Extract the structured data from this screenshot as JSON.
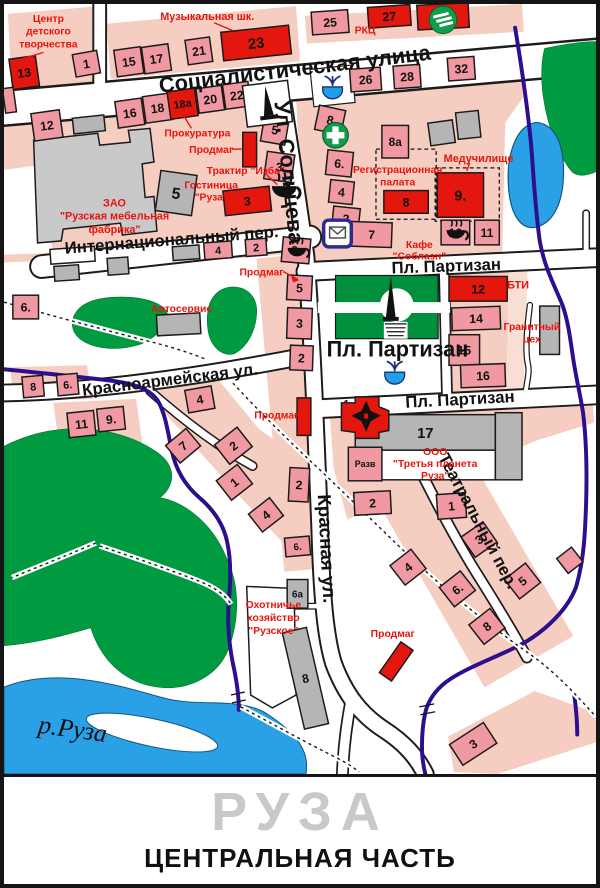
{
  "footer": {
    "city": "РУЗА",
    "subtitle": "ЦЕНТРАЛЬНАЯ ЧАСТЬ"
  },
  "colors": {
    "label_red": "#e8140c",
    "building_red": "#e3170d",
    "building_pink": "#f099a3",
    "block_pink": "#f6cdc1",
    "green": "#009a40",
    "river_blue": "#2aa1e6",
    "stream_purple": "#2c0e8f",
    "road_white": "#ffffff",
    "title_gray": "#c9c9c9"
  },
  "icons": {
    "pharmacy": "green circle with white cross",
    "sberbank": "green circle with three white stripes",
    "post-office": "envelope in blue rounded square",
    "fountain": "blue bowl with water jets",
    "monument": "black obelisk on white square",
    "park-obelisk": "black obelisk with stairs in park circle",
    "church": "red building with black cross",
    "cafe": "black coffee cup with steam"
  },
  "streets": [
    {
      "id": "sotsialisticheskaya",
      "label": "Социалистическая улица",
      "x": 158,
      "y": 90,
      "rot": -7,
      "size": 22
    },
    {
      "id": "solntseva",
      "label": "Ул. Солнцева",
      "x": 274,
      "y": 99,
      "rot": 84,
      "size": 22
    },
    {
      "id": "krasnaya",
      "label": "Красная ул.",
      "x": 318,
      "y": 497,
      "rot": 87,
      "size": 19
    },
    {
      "id": "internatsionalny",
      "label": "Интернациональный пер.",
      "x": 62,
      "y": 253,
      "rot": -4.5,
      "size": 17
    },
    {
      "id": "krasnoarmeyskaya",
      "label": "Красноармейская ул.",
      "x": 80,
      "y": 397,
      "rot": -7,
      "size": 17
    },
    {
      "id": "partizan-upper",
      "label": "Пл. Партизан",
      "x": 393,
      "y": 273,
      "rot": -2,
      "size": 17
    },
    {
      "id": "partizan-square",
      "label": "Пл. Партизан",
      "x": 327,
      "y": 357,
      "rot": 0,
      "size": 22
    },
    {
      "id": "partizan-lower",
      "label": "Пл. Партизан",
      "x": 407,
      "y": 409,
      "rot": -3,
      "size": 17
    },
    {
      "id": "teatralny",
      "label": "Театральный пер.",
      "x": 440,
      "y": 459,
      "rot": 62,
      "size": 17
    },
    {
      "id": "river-ruza",
      "label": "р.Руза",
      "x": 34,
      "y": 738,
      "rot": 8,
      "size": 26,
      "serif": true
    }
  ],
  "poi_labels": [
    {
      "id": "tsentr-tvorchestva",
      "lines": [
        "Центр",
        "детского",
        "творчества"
      ],
      "x": 45,
      "y": 18,
      "lh": 13,
      "size": 10.5
    },
    {
      "id": "muz-shkola",
      "lines": [
        "Музыкальная шк."
      ],
      "x": 206,
      "y": 16,
      "size": 11
    },
    {
      "id": "rkts",
      "lines": [
        "РКЦ"
      ],
      "x": 366,
      "y": 30,
      "size": 10.5
    },
    {
      "id": "prokuratura",
      "lines": [
        "Прокуратура"
      ],
      "x": 196,
      "y": 134,
      "size": 10.5
    },
    {
      "id": "prodmag-1",
      "lines": [
        "Продмаг"
      ],
      "x": 210,
      "y": 151,
      "size": 10.5
    },
    {
      "id": "traktir-izba",
      "lines": [
        "Трактир \"Изба\""
      ],
      "x": 245,
      "y": 172,
      "size": 10.5
    },
    {
      "id": "gostinitsa-ruza",
      "lines": [
        "Гостиница",
        "\"Руза\""
      ],
      "x": 210,
      "y": 187,
      "lh": 12,
      "size": 10.5
    },
    {
      "id": "mebelnaya-fabrika",
      "lines": [
        "ЗАО",
        "\"Рузская мебельная",
        "фабрика\""
      ],
      "x": 112,
      "y": 205,
      "lh": 13.5,
      "size": 11
    },
    {
      "id": "reg-palata",
      "lines": [
        "Регистрационная",
        "палата"
      ],
      "x": 399,
      "y": 171,
      "lh": 13,
      "size": 10.5
    },
    {
      "id": "meduchilishche",
      "lines": [
        "Медучилище"
      ],
      "x": 481,
      "y": 160,
      "size": 11
    },
    {
      "id": "kafe-soblazn",
      "lines": [
        "Кафе",
        "\"Соблазн\""
      ],
      "x": 421,
      "y": 247,
      "lh": 12,
      "size": 10.5
    },
    {
      "id": "bti",
      "lines": [
        "БТИ"
      ],
      "x": 521,
      "y": 288,
      "size": 11
    },
    {
      "id": "granitny-tseh",
      "lines": [
        "Гранитный",
        "цех"
      ],
      "x": 535,
      "y": 330,
      "lh": 13,
      "size": 10.5
    },
    {
      "id": "avtoservis",
      "lines": [
        "Автосервис"
      ],
      "x": 180,
      "y": 312,
      "size": 10.5
    },
    {
      "id": "prodmag-2",
      "lines": [
        "Продмаг"
      ],
      "x": 261,
      "y": 275,
      "size": 10.5
    },
    {
      "id": "prodmag-3",
      "lines": [
        "Продмаг"
      ],
      "x": 276,
      "y": 420,
      "size": 10.5
    },
    {
      "id": "ooo-tretya-planeta",
      "lines": [
        "ООО",
        "\"Третья планета",
        "Руза\""
      ],
      "x": 437,
      "y": 457,
      "lh": 12,
      "size": 10.5
    },
    {
      "id": "ohotniche-hozyaystvo",
      "lines": [
        "Охотничье",
        "хозяйство",
        "\"Рузское\""
      ],
      "x": 273,
      "y": 612,
      "lh": 13,
      "size": 10.5
    },
    {
      "id": "prodmag-4",
      "lines": [
        "Продмаг"
      ],
      "x": 394,
      "y": 641,
      "size": 10.5
    }
  ],
  "buildings": [
    {
      "n": "13",
      "x": 7,
      "y": 54,
      "w": 27,
      "h": 31,
      "r": -8,
      "c": "red"
    },
    {
      "n": "1",
      "x": 71,
      "y": 49,
      "w": 25,
      "h": 23,
      "r": -10,
      "c": "pink"
    },
    {
      "n": "",
      "x": 0,
      "y": 85,
      "w": 11,
      "h": 25,
      "r": -8,
      "c": "pink"
    },
    {
      "n": "15",
      "x": 113,
      "y": 45,
      "w": 27,
      "h": 27,
      "r": -8,
      "c": "pink"
    },
    {
      "n": "17",
      "x": 141,
      "y": 42,
      "w": 27,
      "h": 27,
      "r": -8,
      "c": "pink"
    },
    {
      "n": "21",
      "x": 185,
      "y": 35,
      "w": 25,
      "h": 25,
      "r": -8,
      "c": "pink"
    },
    {
      "n": "23",
      "x": 221,
      "y": 25,
      "w": 69,
      "h": 29,
      "r": -6,
      "c": "red",
      "ts": 15
    },
    {
      "n": "12",
      "x": 29,
      "y": 109,
      "w": 29,
      "h": 28,
      "r": -8,
      "c": "pink"
    },
    {
      "n": "16",
      "x": 114,
      "y": 97,
      "w": 27,
      "h": 27,
      "r": -8,
      "c": "pink"
    },
    {
      "n": "18",
      "x": 142,
      "y": 92,
      "w": 27,
      "h": 27,
      "r": -8,
      "c": "pink"
    },
    {
      "n": "18а",
      "x": 167,
      "y": 87,
      "w": 28,
      "h": 28,
      "r": -8,
      "c": "red",
      "ts": 11
    },
    {
      "n": "20",
      "x": 196,
      "y": 84,
      "w": 26,
      "h": 25,
      "r": -8,
      "c": "pink"
    },
    {
      "n": "22",
      "x": 223,
      "y": 80,
      "w": 26,
      "h": 25,
      "r": -8,
      "c": "pink"
    },
    {
      "n": "",
      "x": 70,
      "y": 114,
      "w": 32,
      "h": 16,
      "r": -6,
      "c": "gray"
    },
    {
      "n": "25",
      "x": 312,
      "y": 7,
      "w": 37,
      "h": 23,
      "r": -4,
      "c": "pink"
    },
    {
      "n": "27",
      "x": 369,
      "y": 2,
      "w": 43,
      "h": 21,
      "r": -4,
      "c": "red"
    },
    {
      "n": "",
      "x": 419,
      "y": 0,
      "w": 52,
      "h": 25,
      "r": -3,
      "c": "red"
    },
    {
      "n": "26",
      "x": 351,
      "y": 65,
      "w": 31,
      "h": 23,
      "r": -4,
      "c": "pink"
    },
    {
      "n": "28",
      "x": 395,
      "y": 62,
      "w": 27,
      "h": 23,
      "r": -4,
      "c": "pink"
    },
    {
      "n": "32",
      "x": 450,
      "y": 54,
      "w": 27,
      "h": 23,
      "r": -4,
      "c": "pink"
    },
    {
      "n": "5",
      "x": 262,
      "y": 114,
      "w": 25,
      "h": 27,
      "r": 10,
      "c": "pink"
    },
    {
      "n": "",
      "x": 242,
      "y": 130,
      "w": 14,
      "h": 35,
      "r": 0,
      "c": "red"
    },
    {
      "n": "3",
      "x": 265,
      "y": 151,
      "w": 28,
      "h": 28,
      "r": 8,
      "c": "pink"
    },
    {
      "n": "3",
      "x": 223,
      "y": 187,
      "w": 47,
      "h": 25,
      "r": -6,
      "c": "red"
    },
    {
      "n": "6.",
      "x": 282,
      "y": 237,
      "w": 28,
      "h": 25,
      "r": 5,
      "c": "pink"
    },
    {
      "n": "5",
      "x": 287,
      "y": 275,
      "w": 25,
      "h": 25,
      "r": 3,
      "c": "pink"
    },
    {
      "n": "3",
      "x": 287,
      "y": 308,
      "w": 25,
      "h": 31,
      "r": 2,
      "c": "pink"
    },
    {
      "n": "2",
      "x": 290,
      "y": 346,
      "w": 23,
      "h": 25,
      "r": 2,
      "c": "pink"
    },
    {
      "n": "8",
      "x": 317,
      "y": 105,
      "w": 27,
      "h": 25,
      "r": 12,
      "c": "pink"
    },
    {
      "n": "6.",
      "x": 327,
      "y": 149,
      "w": 26,
      "h": 25,
      "r": 6,
      "c": "pink"
    },
    {
      "n": "4",
      "x": 330,
      "y": 179,
      "w": 24,
      "h": 23,
      "r": 6,
      "c": "pink"
    },
    {
      "n": "2",
      "x": 333,
      "y": 206,
      "w": 27,
      "h": 23,
      "r": 6,
      "c": "pink"
    },
    {
      "n": "7",
      "x": 352,
      "y": 221,
      "w": 41,
      "h": 25,
      "r": 2,
      "c": "pink"
    },
    {
      "n": "8а",
      "x": 383,
      "y": 123,
      "w": 27,
      "h": 33,
      "r": 0,
      "c": "pink",
      "ts": 12
    },
    {
      "n": "",
      "x": 431,
      "y": 119,
      "w": 25,
      "h": 23,
      "r": -8,
      "c": "gray"
    },
    {
      "n": "",
      "x": 459,
      "y": 109,
      "w": 23,
      "h": 27,
      "r": -6,
      "c": "gray"
    },
    {
      "n": "8",
      "x": 385,
      "y": 189,
      "w": 45,
      "h": 23,
      "r": 0,
      "c": "red"
    },
    {
      "n": "9.",
      "x": 439,
      "y": 171,
      "w": 47,
      "h": 45,
      "r": 0,
      "c": "red",
      "ts": 15
    },
    {
      "n": "10",
      "x": 443,
      "y": 219,
      "w": 29,
      "h": 25,
      "r": 0,
      "c": "pink"
    },
    {
      "n": "11",
      "x": 477,
      "y": 219,
      "w": 25,
      "h": 25,
      "r": 0,
      "c": "pink"
    },
    {
      "n": "12",
      "x": 451,
      "y": 276,
      "w": 59,
      "h": 25,
      "r": 0,
      "c": "red"
    },
    {
      "n": "14",
      "x": 454,
      "y": 307,
      "w": 49,
      "h": 23,
      "r": -2,
      "c": "pink"
    },
    {
      "n": "15",
      "x": 451,
      "y": 335,
      "w": 31,
      "h": 31,
      "r": 0,
      "c": "pink"
    },
    {
      "n": "16",
      "x": 463,
      "y": 365,
      "w": 45,
      "h": 23,
      "r": -2,
      "c": "pink"
    },
    {
      "n": "",
      "x": 543,
      "y": 306,
      "w": 20,
      "h": 49,
      "r": 0,
      "c": "gray"
    },
    {
      "n": "17",
      "x": 356,
      "y": 416,
      "w": 142,
      "h": 36,
      "r": 0,
      "c": "gray",
      "ts": 15
    },
    {
      "n": "",
      "x": 356,
      "y": 452,
      "w": 142,
      "h": 30,
      "r": 0,
      "c": "white"
    },
    {
      "n": "",
      "x": 498,
      "y": 414,
      "w": 27,
      "h": 68,
      "r": 0,
      "c": "gray"
    },
    {
      "n": "Разв",
      "x": 349,
      "y": 449,
      "w": 34,
      "h": 34,
      "r": 0,
      "c": "pink",
      "ts": 9,
      "tc": "#e8140c"
    },
    {
      "n": "2",
      "x": 355,
      "y": 494,
      "w": 37,
      "h": 23,
      "r": -3,
      "c": "pink"
    },
    {
      "n": "1",
      "x": 439,
      "y": 496,
      "w": 29,
      "h": 25,
      "r": -4,
      "c": "pink"
    },
    {
      "n": "1",
      "x": 340,
      "y": 398,
      "w": 14,
      "h": 14,
      "r": 0,
      "c": "none",
      "ts": 11
    },
    {
      "n": "8",
      "x": 19,
      "y": 377,
      "w": 21,
      "h": 21,
      "r": -5,
      "c": "pink",
      "ts": 11
    },
    {
      "n": "6.",
      "x": 54,
      "y": 375,
      "w": 21,
      "h": 21,
      "r": -5,
      "c": "pink",
      "ts": 11
    },
    {
      "n": "11",
      "x": 65,
      "y": 413,
      "w": 27,
      "h": 25,
      "r": -6,
      "c": "pink"
    },
    {
      "n": "9.",
      "x": 95,
      "y": 409,
      "w": 27,
      "h": 23,
      "r": -6,
      "c": "pink"
    },
    {
      "n": "6.",
      "x": 9,
      "y": 295,
      "w": 26,
      "h": 24,
      "r": 0,
      "c": "pink"
    },
    {
      "n": "",
      "x": 155,
      "y": 314,
      "w": 44,
      "h": 21,
      "r": -3,
      "c": "gray"
    },
    {
      "n": "4",
      "x": 185,
      "y": 389,
      "w": 27,
      "h": 23,
      "r": -10,
      "c": "pink"
    },
    {
      "n": "7",
      "x": 168,
      "y": 436,
      "w": 27,
      "h": 23,
      "r": -40,
      "c": "pink"
    },
    {
      "n": "2",
      "x": 218,
      "y": 435,
      "w": 29,
      "h": 25,
      "r": -38,
      "c": "pink"
    },
    {
      "n": "1",
      "x": 220,
      "y": 472,
      "w": 27,
      "h": 25,
      "r": -38,
      "c": "pink"
    },
    {
      "n": "4",
      "x": 252,
      "y": 506,
      "w": 27,
      "h": 23,
      "r": -38,
      "c": "pink"
    },
    {
      "n": "2",
      "x": 289,
      "y": 470,
      "w": 20,
      "h": 34,
      "r": 3,
      "c": "pink"
    },
    {
      "n": "",
      "x": 297,
      "y": 399,
      "w": 14,
      "h": 38,
      "r": 0,
      "c": "red"
    },
    {
      "n": "4",
      "x": 203,
      "y": 241,
      "w": 28,
      "h": 17,
      "r": -4,
      "c": "pink",
      "ts": 11
    },
    {
      "n": "2",
      "x": 245,
      "y": 238,
      "w": 21,
      "h": 17,
      "r": -4,
      "c": "pink",
      "ts": 11
    },
    {
      "n": "4",
      "x": 396,
      "y": 558,
      "w": 27,
      "h": 25,
      "r": -38,
      "c": "pink"
    },
    {
      "n": "6.",
      "x": 446,
      "y": 580,
      "w": 27,
      "h": 25,
      "r": -38,
      "c": "pink"
    },
    {
      "n": "3",
      "x": 468,
      "y": 530,
      "w": 27,
      "h": 25,
      "r": -35,
      "c": "pink"
    },
    {
      "n": "5",
      "x": 512,
      "y": 572,
      "w": 27,
      "h": 25,
      "r": -38,
      "c": "pink"
    },
    {
      "n": "8",
      "x": 476,
      "y": 618,
      "w": 27,
      "h": 25,
      "r": -38,
      "c": "pink"
    },
    {
      "n": "",
      "x": 564,
      "y": 554,
      "w": 19,
      "h": 19,
      "r": -38,
      "c": "pink"
    },
    {
      "n": "3",
      "x": 455,
      "y": 737,
      "w": 41,
      "h": 25,
      "r": -33,
      "c": "pink"
    },
    {
      "n": "",
      "x": 390,
      "y": 647,
      "w": 15,
      "h": 38,
      "r": 35,
      "c": "red"
    },
    {
      "n": "6а",
      "x": 287,
      "y": 583,
      "w": 21,
      "h": 29,
      "r": 0,
      "c": "gray",
      "ts": 10
    },
    {
      "n": "8",
      "x": 293,
      "y": 633,
      "w": 25,
      "h": 100,
      "r": -13,
      "c": "gray"
    },
    {
      "n": "6.",
      "x": 285,
      "y": 540,
      "w": 25,
      "h": 19,
      "r": -5,
      "c": "pink",
      "ts": 10
    },
    {
      "n": "5",
      "x": 156,
      "y": 171,
      "w": 37,
      "h": 41,
      "r": 8,
      "c": "gray",
      "ts": 16
    },
    {
      "n": "",
      "x": 47,
      "y": 247,
      "w": 45,
      "h": 15,
      "r": -4,
      "c": "white"
    },
    {
      "n": "",
      "x": 51,
      "y": 265,
      "w": 25,
      "h": 15,
      "r": -4,
      "c": "gray"
    },
    {
      "n": "",
      "x": 105,
      "y": 257,
      "w": 21,
      "h": 17,
      "r": -4,
      "c": "gray"
    },
    {
      "n": "",
      "x": 171,
      "y": 245,
      "w": 27,
      "h": 14,
      "r": -4,
      "c": "gray"
    }
  ]
}
